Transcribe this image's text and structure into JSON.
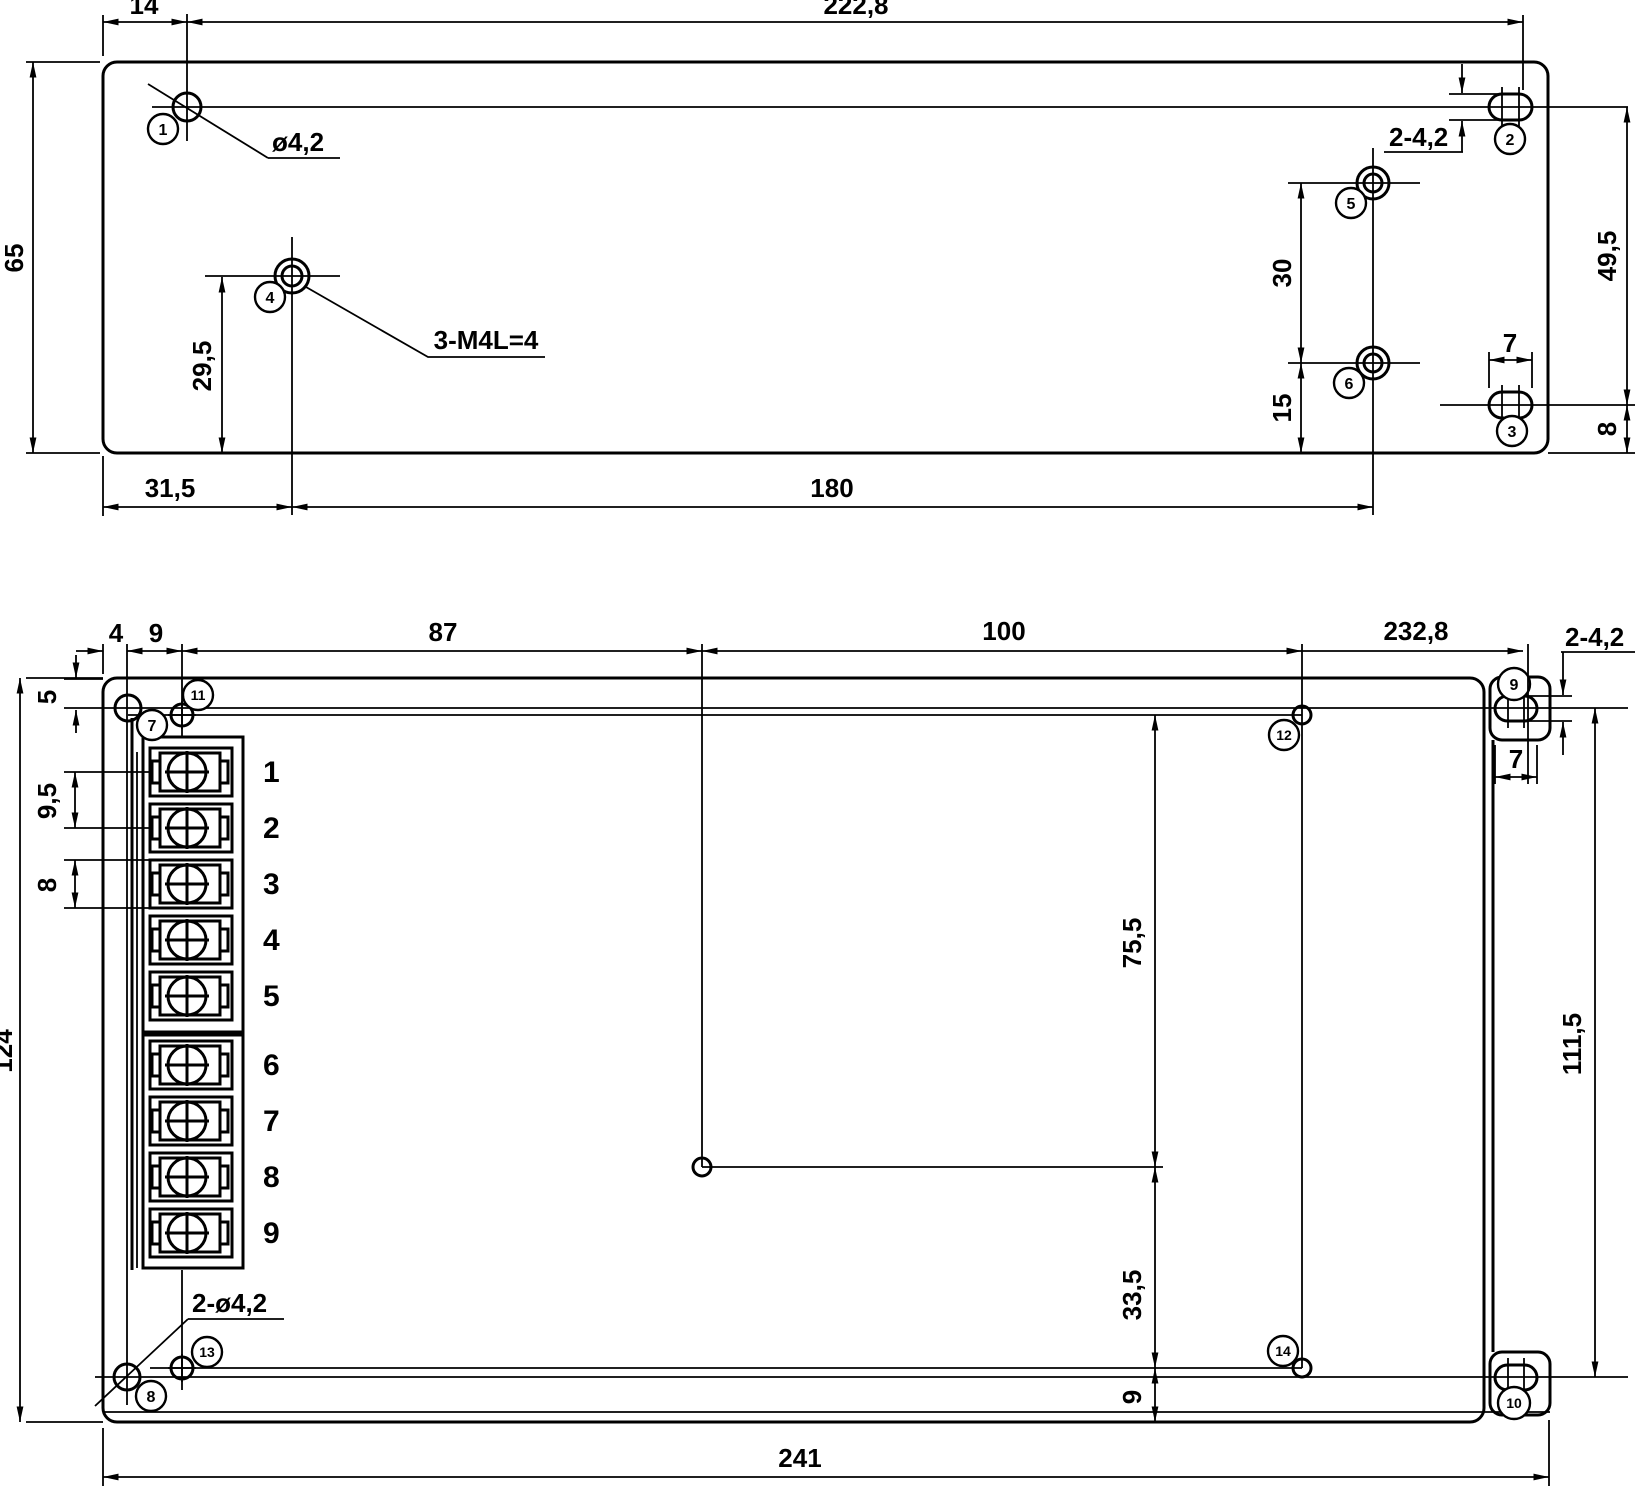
{
  "top_view": {
    "dims": {
      "d14": "14",
      "d222_8": "222,8",
      "d65": "65",
      "d29_5": "29,5",
      "d31_5": "31,5",
      "d180": "180",
      "d30": "30",
      "d15": "15",
      "d49_5": "49,5",
      "d7": "7",
      "d8": "8"
    },
    "labels": {
      "slot_note": "2-4,2",
      "hole_note": "ø4,2",
      "tap_note": "3-M4L=4"
    },
    "balloons": {
      "b1": "1",
      "b2": "2",
      "b3": "3",
      "b4": "4",
      "b5": "5",
      "b6": "6"
    }
  },
  "bottom_view": {
    "dims": {
      "d4": "4",
      "d9": "9",
      "d87": "87",
      "d100": "100",
      "d232_8": "232,8",
      "d5": "5",
      "d9_5": "9,5",
      "d8": "8",
      "d124": "124",
      "d75_5": "75,5",
      "d33_5": "33,5",
      "d9b": "9",
      "d111_5": "111,5",
      "d241": "241",
      "d7": "7"
    },
    "labels": {
      "slot_note": "2-4,2",
      "holes_note": "2-ø4,2"
    },
    "balloons": {
      "b7": "7",
      "b8": "8",
      "b9": "9",
      "b10": "10",
      "b11": "11",
      "b12": "12",
      "b13": "13",
      "b14": "14"
    },
    "terminals": [
      "1",
      "2",
      "3",
      "4",
      "5",
      "6",
      "7",
      "8",
      "9"
    ]
  }
}
